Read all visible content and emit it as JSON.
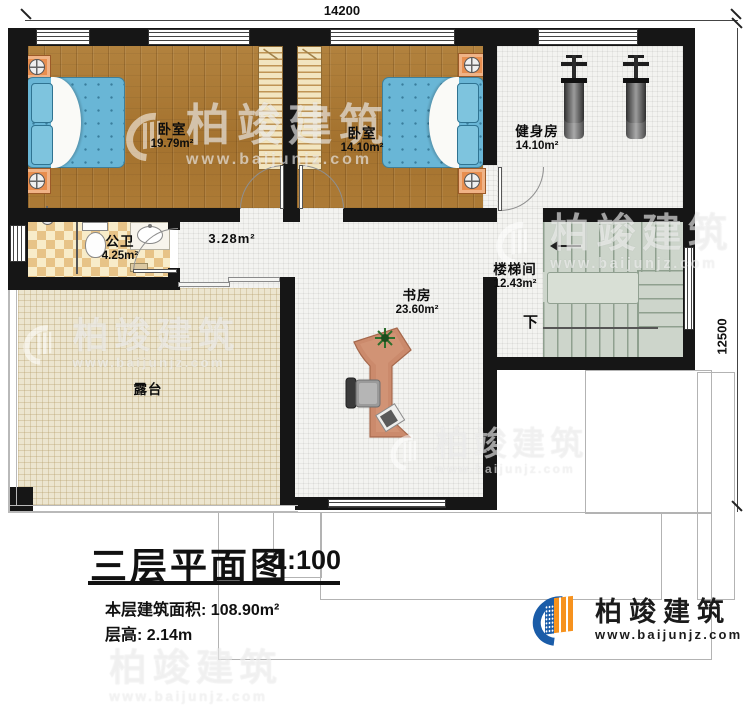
{
  "dimensions": {
    "width_mm": "14200",
    "depth_mm": "12500"
  },
  "rooms": {
    "bedroom1": {
      "name": "卧室",
      "area": "19.79m²"
    },
    "bedroom2": {
      "name": "卧室",
      "area": "14.10m²"
    },
    "gym": {
      "name": "健身房",
      "area": "14.10m²"
    },
    "bathroom": {
      "name": "公卫",
      "area": "4.25m²"
    },
    "hallway": {
      "area": "3.28m²"
    },
    "stairwell": {
      "name": "楼梯间",
      "area": "12.43m²",
      "direction": "下"
    },
    "study": {
      "name": "书房",
      "area": "23.60m²"
    },
    "terrace": {
      "name": "露台"
    }
  },
  "title_block": {
    "title": "三层平面图",
    "scale": "1:100",
    "floor_area_label": "本层建筑面积:",
    "floor_area_value": "108.90m²",
    "floor_height_label": "层高:",
    "floor_height_value": "2.14m"
  },
  "brand": {
    "name": "柏竣建筑",
    "website": "www.baijunjz.com"
  },
  "watermark": {
    "name": "柏竣建筑",
    "website": "www.baijunjz.com"
  },
  "colors": {
    "wall": "#161616",
    "wood_floor": "#a9772f",
    "tile_floor": "#f3f3f0",
    "terrace_floor": "#ece5cf",
    "bathroom_tile": "#e7c387",
    "stairs": "#cdd5cb",
    "bed": "#69b6d6",
    "nightstand": "#e88e4f",
    "desk": "#cb8a6c",
    "logo_blue": "#1a5ca8",
    "logo_orange": "#f6921e"
  }
}
